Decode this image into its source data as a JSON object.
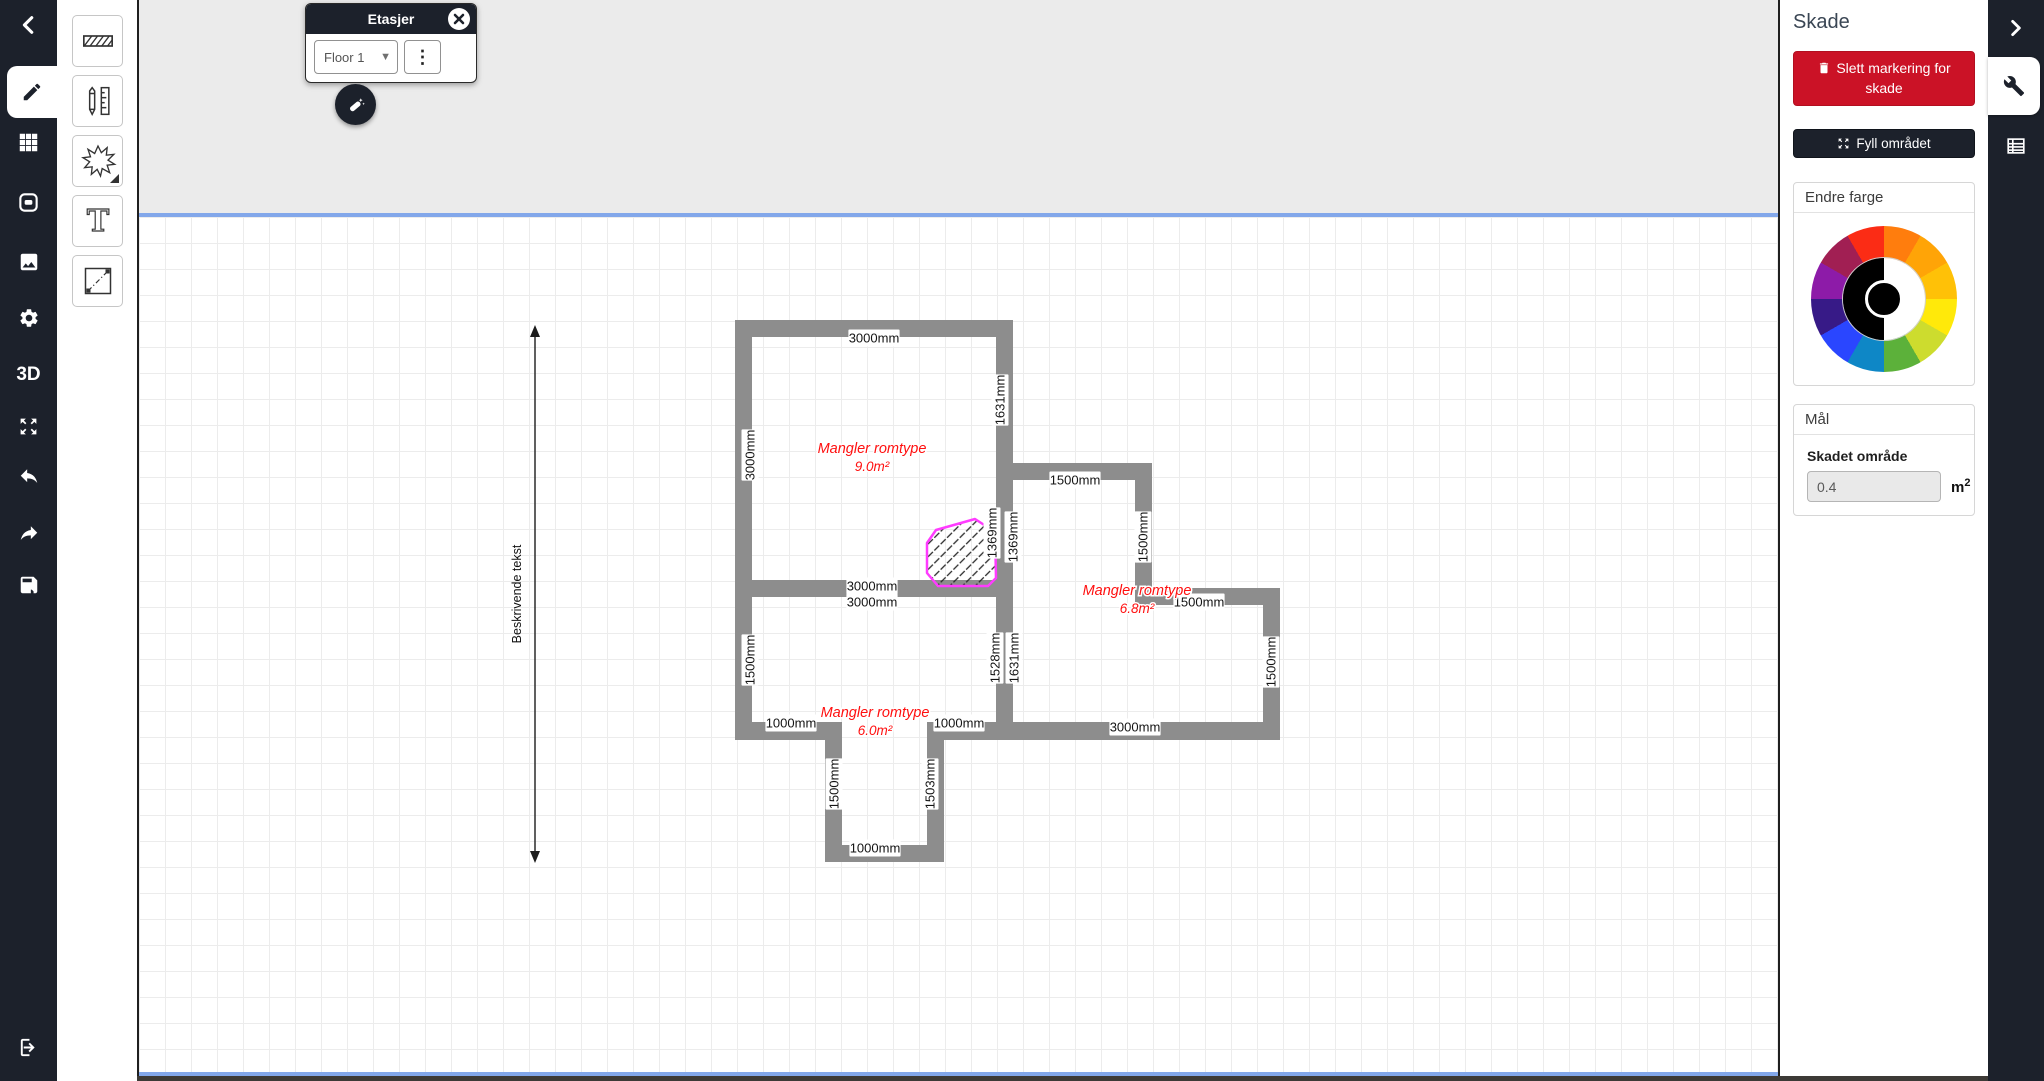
{
  "left_sidebar": {
    "threed_label": "3D",
    "items": [
      "back",
      "draw",
      "grid",
      "device",
      "image",
      "settings",
      "3d",
      "fullscreen",
      "undo",
      "redo",
      "save",
      "logout"
    ]
  },
  "tool_strip": {
    "tools": [
      "wall-hatch",
      "pencil-ruler",
      "starburst",
      "text",
      "diagonal-measure"
    ]
  },
  "floors_panel": {
    "title": "Etasjer",
    "selected_floor": "Floor 1"
  },
  "right_panel": {
    "title": "Skade",
    "delete_damage_button": "Slett markering for skade",
    "fill_area_button": "Fyll området",
    "color_section_title": "Endre farge",
    "color_wheel_segments": [
      "#ff7d0d",
      "#ffa407",
      "#ffc107",
      "#ffe90a",
      "#cddc2e",
      "#5cb13a",
      "#0e87c6",
      "#2a46ff",
      "#371a87",
      "#8d1ba8",
      "#a11f53",
      "#fb2c15"
    ],
    "measure_section_title": "Mål",
    "damaged_area_label": "Skadet område",
    "damaged_area_value": "0.4",
    "unit_base": "m",
    "unit_exponent": "2"
  },
  "canvas": {
    "floor_plan": {
      "wall_color": "#8d8d8d",
      "dim_text_color": "#141414",
      "room_text_color": "#ff0f0f",
      "walls": [
        [
          733,
          320,
          278,
          17
        ],
        [
          733,
          320,
          17,
          420
        ],
        [
          994,
          320,
          17,
          285
        ],
        [
          733,
          580,
          278,
          17
        ],
        [
          1011,
          463,
          139,
          17
        ],
        [
          1133,
          463,
          17,
          142
        ],
        [
          1150,
          588,
          128,
          17
        ],
        [
          1261,
          588,
          17,
          152
        ],
        [
          1011,
          722,
          267,
          18
        ],
        [
          994,
          580,
          17,
          160
        ],
        [
          733,
          722,
          107,
          18
        ],
        [
          925,
          722,
          86,
          18
        ],
        [
          823,
          722,
          17,
          140
        ],
        [
          925,
          722,
          17,
          140
        ],
        [
          823,
          845,
          119,
          17
        ]
      ],
      "dim_labels": [
        {
          "t": "3000mm",
          "x": 872,
          "y": 338,
          "v": false
        },
        {
          "t": "3000mm",
          "x": 870,
          "y": 586,
          "v": false
        },
        {
          "t": "3000mm",
          "x": 870,
          "y": 602,
          "v": false
        },
        {
          "t": "1500mm",
          "x": 1073,
          "y": 480,
          "v": false
        },
        {
          "t": "1500mm",
          "x": 1197,
          "y": 602,
          "v": false
        },
        {
          "t": "3000mm",
          "x": 1133,
          "y": 727,
          "v": false
        },
        {
          "t": "1000mm",
          "x": 789,
          "y": 723,
          "v": false
        },
        {
          "t": "1000mm",
          "x": 957,
          "y": 723,
          "v": false
        },
        {
          "t": "1000mm",
          "x": 873,
          "y": 848,
          "v": false
        },
        {
          "t": "3000mm",
          "x": 748,
          "y": 455,
          "v": true
        },
        {
          "t": "1631mm",
          "x": 998,
          "y": 400,
          "v": true
        },
        {
          "t": "1369mm",
          "x": 990,
          "y": 533,
          "v": true
        },
        {
          "t": "1369mm",
          "x": 1011,
          "y": 537,
          "v": true
        },
        {
          "t": "1500mm",
          "x": 1141,
          "y": 537,
          "v": true
        },
        {
          "t": "1500mm",
          "x": 1269,
          "y": 662,
          "v": true
        },
        {
          "t": "1528mm",
          "x": 993,
          "y": 658,
          "v": true
        },
        {
          "t": "1631mm",
          "x": 1012,
          "y": 658,
          "v": true
        },
        {
          "t": "1500mm",
          "x": 748,
          "y": 660,
          "v": true
        },
        {
          "t": "1500mm",
          "x": 832,
          "y": 784,
          "v": true
        },
        {
          "t": "1503mm",
          "x": 928,
          "y": 784,
          "v": true
        }
      ],
      "rooms": [
        {
          "line1": "Mangler romtype",
          "line2": "9.0m²",
          "x": 870,
          "y": 448
        },
        {
          "line1": "Mangler romtype",
          "line2": "6.8m²",
          "x": 1135,
          "y": 590
        },
        {
          "line1": "Mangler romtype",
          "line2": "6.0m²",
          "x": 873,
          "y": 712
        }
      ],
      "damage": {
        "color": "#ff3bff",
        "points": "973,519 993,532 994,578 986,586 936,586 925,573 925,543 934,530"
      },
      "arrow": {
        "x": 533,
        "y1": 325,
        "y2": 863,
        "label": "Beskrivende tekst"
      }
    }
  }
}
